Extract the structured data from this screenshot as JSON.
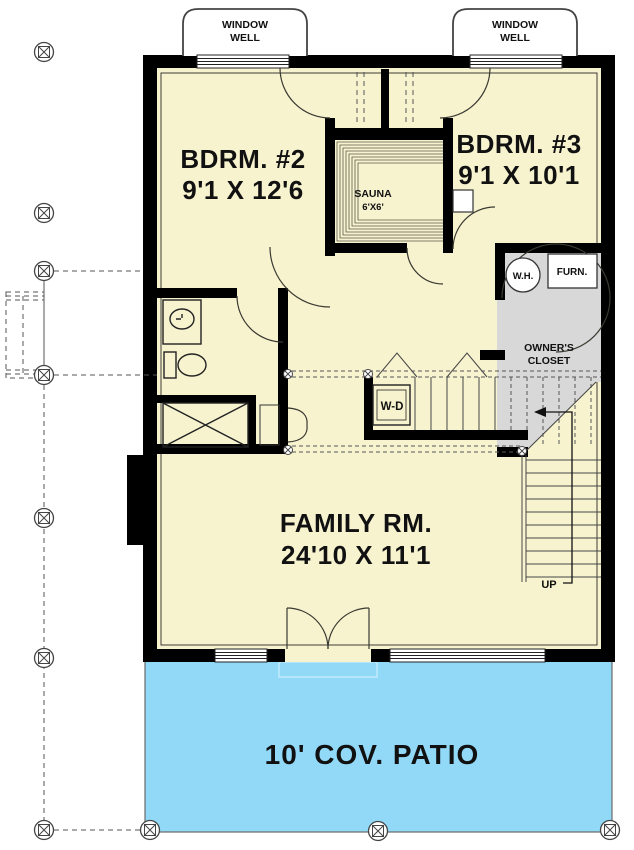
{
  "labels": {
    "window_well_1": {
      "line1": "WINDOW",
      "line2": "WELL"
    },
    "window_well_2": {
      "line1": "WINDOW",
      "line2": "WELL"
    },
    "bdrm2": {
      "name": "BDRM. #2",
      "dims": "9'1 X 12'6"
    },
    "bdrm3": {
      "name": "BDRM. #3",
      "dims": "9'1 X 10'1"
    },
    "sauna": {
      "name": "SAUNA",
      "dims": "6'X6'"
    },
    "water_heater": "W.H.",
    "furnace": "FURN.",
    "owners_closet": {
      "line1": "OWNER'S",
      "line2": "CLOSET"
    },
    "washer_dryer": "W-D",
    "family_room": {
      "name": "FAMILY RM.",
      "dims": "24'10 X 11'1"
    },
    "stairs_up": "UP",
    "patio": "10' COV. PATIO"
  },
  "colors": {
    "floor": "#F7F3CF",
    "patio": "#92D9F8",
    "closet_gray": "#D8D8D8",
    "wall": "#000000"
  }
}
